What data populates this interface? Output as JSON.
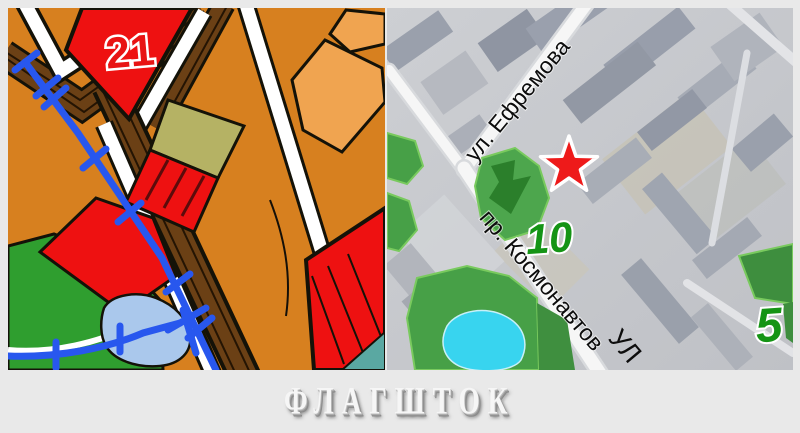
{
  "page": {
    "background": "#e9e9e9"
  },
  "left_map": {
    "type": "zoning-plan-fragment",
    "parcel_label": "21",
    "colors": {
      "background_orange": "#d7801f",
      "parcel_light_orange": "#f0a450",
      "parcel_red": "#ee1111",
      "parcel_olive": "#b5b264",
      "road_brown": "#6b4015",
      "road_white": "#ffffff",
      "outline_black": "#141208",
      "utility_blue": "#2857ee",
      "green_area": "#2f9e2f",
      "pond_blue": "#aac8ec",
      "teal_area": "#5aa8a2",
      "label_red": "#e81414"
    }
  },
  "right_map": {
    "type": "satellite-fragment",
    "streets": [
      {
        "label": "ул. Ефремова"
      },
      {
        "label": "пр. Космонавтов"
      },
      {
        "label": "УЛ"
      }
    ],
    "numbers": [
      {
        "value": "10"
      },
      {
        "value": "5"
      }
    ],
    "marker": {
      "type": "star",
      "color": "#ee1a1a",
      "outline": "#ffffff"
    },
    "number_color": "#159415",
    "street_text_color": "#0d0d0d"
  },
  "footer": {
    "brand": "ФЛАГШТОК"
  }
}
